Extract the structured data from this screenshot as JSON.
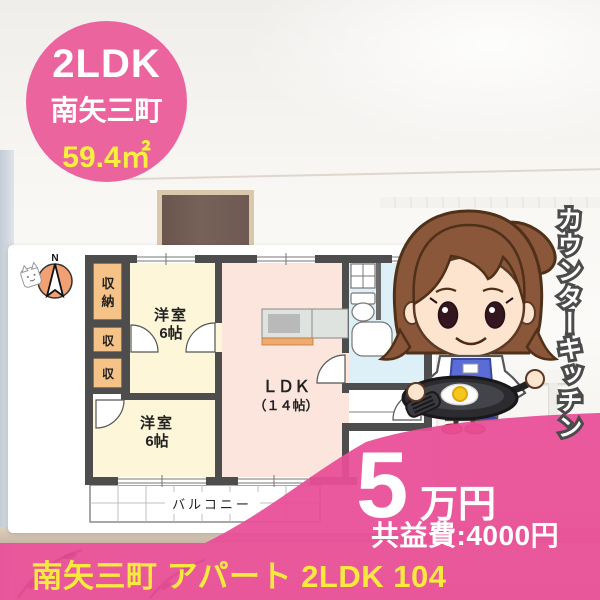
{
  "badge": {
    "layout_type": "2LDK",
    "location": "南矢三町",
    "area": "59.4㎡"
  },
  "floor_plan": {
    "compass": "N",
    "labels": {
      "closet_main_1": "収",
      "closet_main_2": "納",
      "closet_small_1": "収",
      "closet_small_2": "収",
      "bedroom_top_name": "洋室",
      "bedroom_top_size": "6帖",
      "bedroom_bottom_name": "洋室",
      "bedroom_bottom_size": "6帖",
      "ldk_name": "ＬＤＫ",
      "ldk_size": "（１４帖）",
      "balcony": "バルコニー"
    }
  },
  "ribbon": "カウンターキッチン",
  "price": {
    "amount": "5",
    "unit": "万円",
    "maintenance_fee": "共益費:4000円"
  },
  "title": "南矢三町 アパート 2LDK 104",
  "colors": {
    "pink_main": "#e94f97",
    "pink_badge": "#ec649e",
    "accent_yellow": "#f8e93f",
    "wall_gray": "#4d4d4d"
  }
}
